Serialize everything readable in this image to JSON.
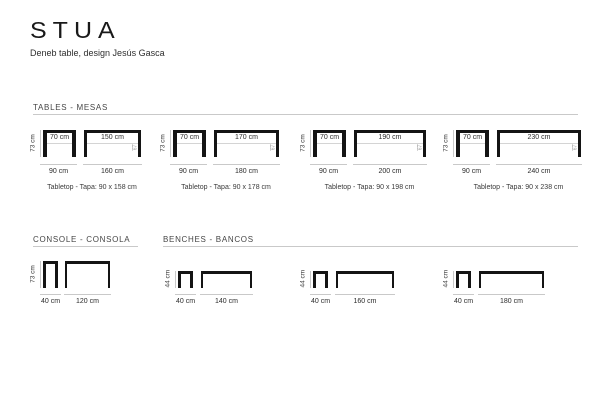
{
  "brand": {
    "logo": "STUA",
    "subtitle": "Deneb table, design Jesús Gasca"
  },
  "sections": {
    "tables_title": "TABLES - MESAS",
    "console_title": "CONSOLE - CONSOLA",
    "benches_title": "BENCHES - BANCOS"
  },
  "tables": {
    "items": [
      {
        "height": "73 cm",
        "front_top": "70 cm",
        "front_bottom": "90 cm",
        "side_top": "150 cm",
        "side_bottom": "160 cm",
        "caption": "Tabletop - Tapa: 90 x 158 cm",
        "mark": "67"
      },
      {
        "height": "73 cm",
        "front_top": "70 cm",
        "front_bottom": "90 cm",
        "side_top": "170 cm",
        "side_bottom": "180 cm",
        "caption": "Tabletop - Tapa: 90 x 178 cm",
        "mark": "67"
      },
      {
        "height": "73 cm",
        "front_top": "70 cm",
        "front_bottom": "90 cm",
        "side_top": "190 cm",
        "side_bottom": "200 cm",
        "caption": "Tabletop - Tapa: 90 x 198 cm",
        "mark": "67"
      },
      {
        "height": "73 cm",
        "front_top": "70 cm",
        "front_bottom": "90 cm",
        "side_top": "230 cm",
        "side_bottom": "240 cm",
        "caption": "Tabletop - Tapa: 90 x 238 cm",
        "mark": "67"
      }
    ]
  },
  "console": {
    "items": [
      {
        "height": "73 cm",
        "front_bottom": "40 cm",
        "side_bottom": "120 cm"
      }
    ]
  },
  "benches": {
    "items": [
      {
        "height": "44 cm",
        "front_bottom": "40 cm",
        "side_bottom": "140 cm"
      },
      {
        "height": "44 cm",
        "front_bottom": "40 cm",
        "side_bottom": "160 cm"
      },
      {
        "height": "44 cm",
        "front_bottom": "40 cm",
        "side_bottom": "180 cm"
      }
    ]
  }
}
